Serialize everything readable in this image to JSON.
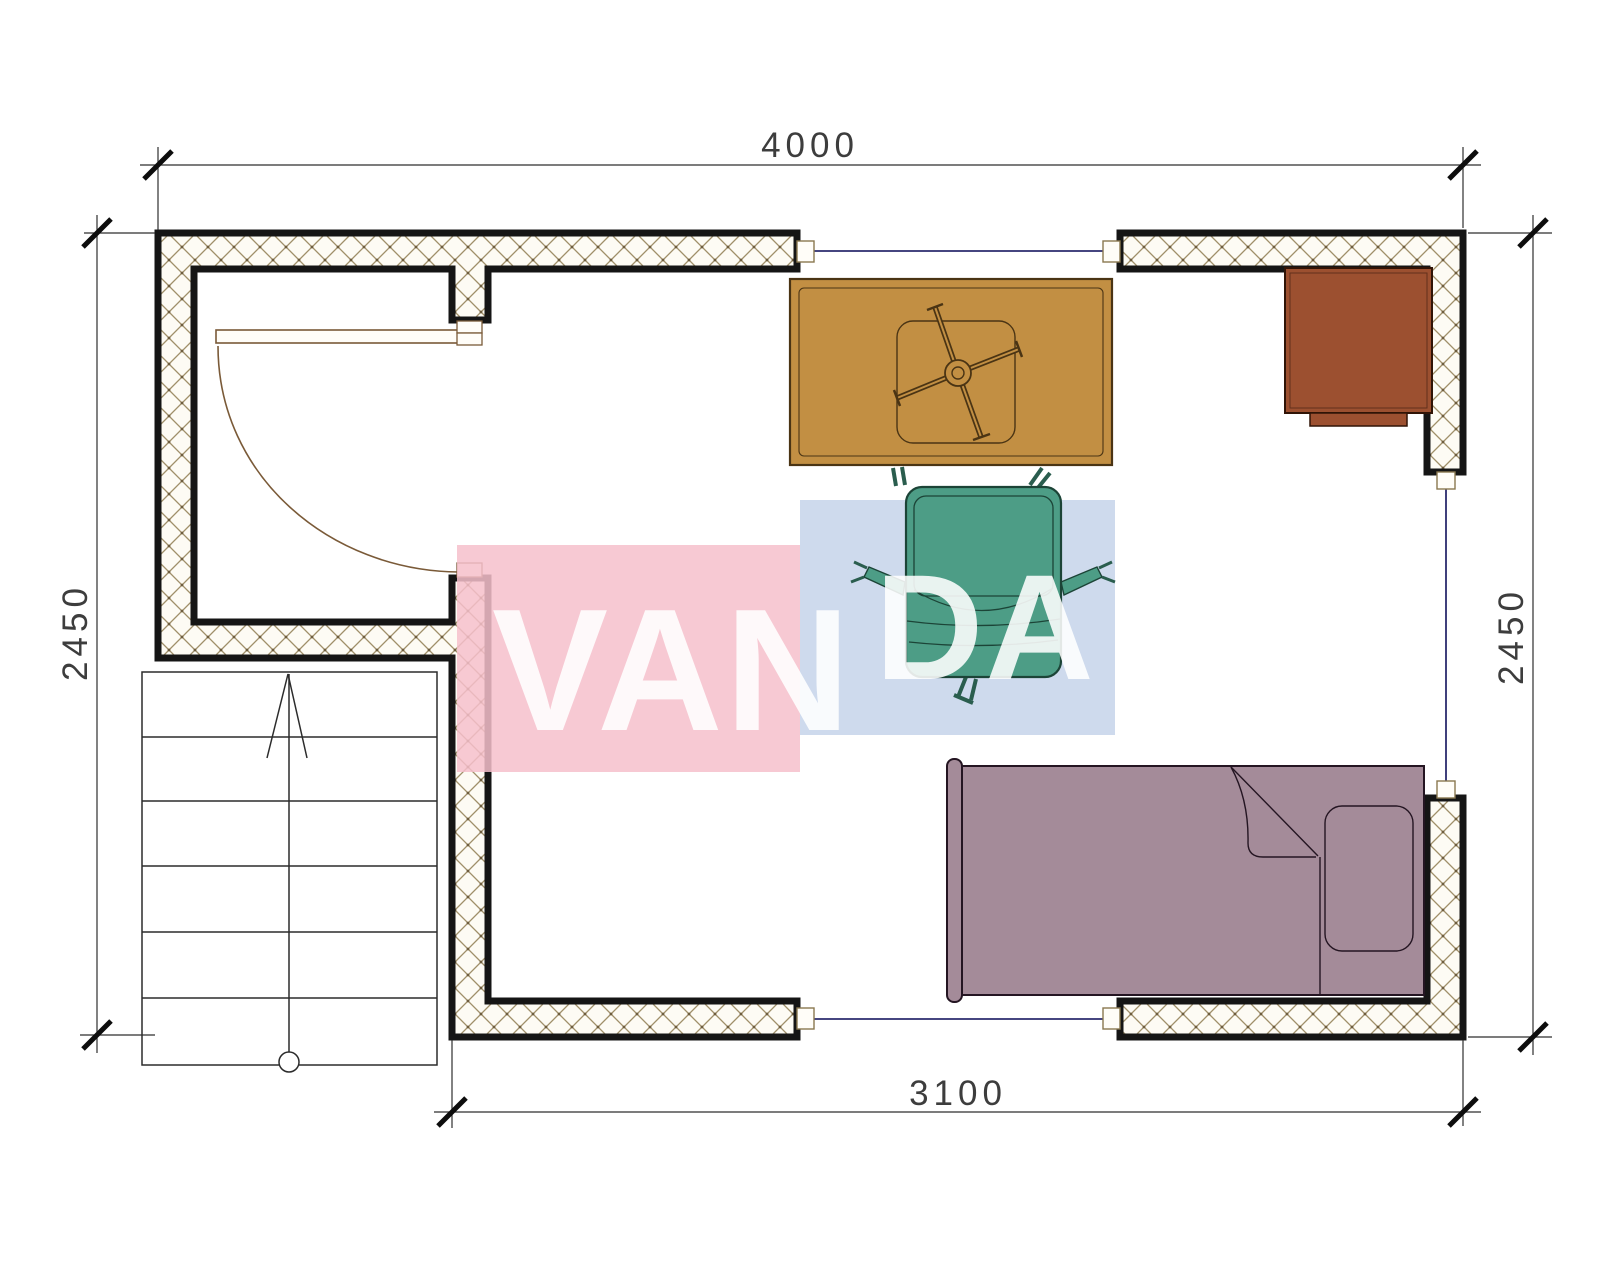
{
  "page": {
    "type": "architectural-floor-plan",
    "background": "#ffffff"
  },
  "dimensions": {
    "top": {
      "label": "4000"
    },
    "left": {
      "label": "2450"
    },
    "right": {
      "label": "2450"
    },
    "bottom": {
      "label": "3100"
    }
  },
  "watermark": {
    "full_text": "VANDA",
    "part_pink": "VAN",
    "part_blue": "DA",
    "pink_color": "#f6bfcb",
    "blue_color": "#c5d4ea",
    "text_color": "#ffffff"
  },
  "plan": {
    "wall_border_color": "#151515",
    "hatch_line_color": "#a08f6a",
    "hatch_bg_color": "#fdfbf4",
    "window_line_color": "#2b2b6e",
    "door_color": "#7a5a38",
    "stairs_line_color": "#2c2c2c",
    "furniture": [
      {
        "name": "dining-table",
        "color": "#c28f43",
        "outline": "#4a3414"
      },
      {
        "name": "office-chair",
        "color": "#4d9d86",
        "outline": "#1c4437"
      },
      {
        "name": "cabinet",
        "color": "#9c5030",
        "outline": "#301407"
      },
      {
        "name": "bed",
        "color": "#a48b99",
        "outline": "#241522"
      },
      {
        "name": "stairs",
        "color": "#ffffff",
        "outline": "#2c2c2c"
      }
    ]
  }
}
